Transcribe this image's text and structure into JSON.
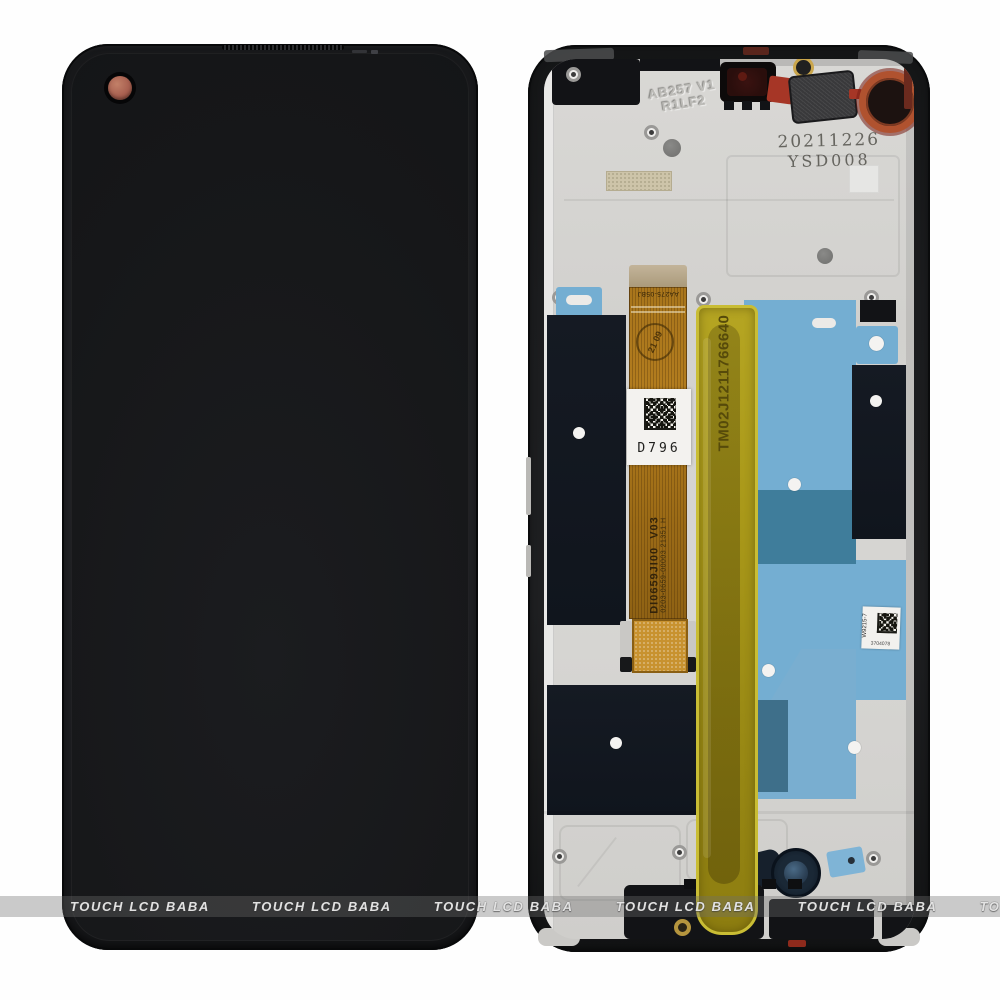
{
  "watermark": {
    "text": "TOUCH LCD BABA"
  },
  "right_phone": {
    "stamp": {
      "date": "20211226",
      "code": "YSD008"
    },
    "embossed": {
      "line1": "AB257 V1",
      "line2": "R1LF2"
    },
    "flex": {
      "top_code": "AA275-05BJ",
      "qc_stamp": "21 09",
      "label_code": "D796",
      "part_number": "DI0659JI00  V03",
      "serial": "0203-0659-00003 21351 H"
    },
    "tape": {
      "serial": "TM02J1211766640"
    },
    "side_label": {
      "code": "W9215-7",
      "number": "3704078"
    },
    "colors": {
      "frame_black": "#1a1b1d",
      "plate_silver": "#d5d4d1",
      "adhesive_blue": "#74aed2",
      "adhesive_teal": "#3f7d9b",
      "flex_amber": "#a9761c",
      "tape_yellow": "#a79718",
      "coil_copper": "#b0522f",
      "punch_hole_brown": "#a86050"
    }
  }
}
